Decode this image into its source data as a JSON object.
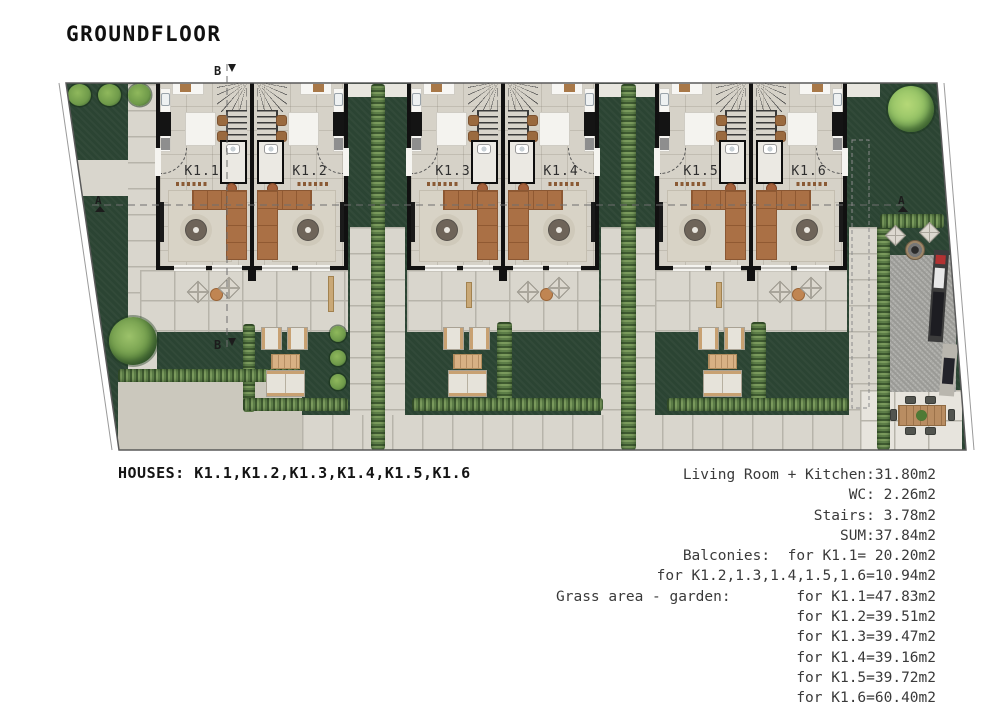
{
  "title": "GROUNDFLOOR",
  "plan": {
    "markers": {
      "top": "B",
      "bottom": "B",
      "left": "A",
      "right": "A"
    },
    "buildings": [
      {
        "left_label": "K1.1",
        "right_label": "K1.2"
      },
      {
        "left_label": "K1.3",
        "right_label": "K1.4"
      },
      {
        "left_label": "K1.5",
        "right_label": "K1.6"
      }
    ],
    "legend_colors": {
      "grass": "#2b4433",
      "hedge": "#5d7e48",
      "pavement": "#d9d6cd",
      "cobblestone": "#cbc8bd",
      "gravel": "#a9a9a5",
      "building_floor": "#d6d2c8",
      "walls": "#111111",
      "sofa": "#aa7045",
      "wood": "#c8a072",
      "outdoor_furniture": "#e6e3da",
      "tree": "#6f9a4a"
    }
  },
  "summary": {
    "houses_label": "HOUSES: ",
    "houses_value": "K1.1,K1.2,K1.3,K1.4,K1.5,K1.6",
    "areas": [
      "Living Room + Kitchen:31.80m2",
      "WC: 2.26m2",
      "Stairs: 3.78m2",
      "SUM:37.84m2",
      "Balconies:  for K1.1= 20.20m2",
      "for K1.2,1.3,1.4,1.5,1.6=10.94m2"
    ],
    "grass": {
      "label": "Grass area - garden:",
      "items": [
        "for K1.1=47.83m2",
        "for K1.2=39.51m2",
        "for K1.3=39.47m2",
        "for K1.4=39.16m2",
        "for K1.5=39.72m2",
        "for K1.6=60.40m2"
      ]
    }
  }
}
